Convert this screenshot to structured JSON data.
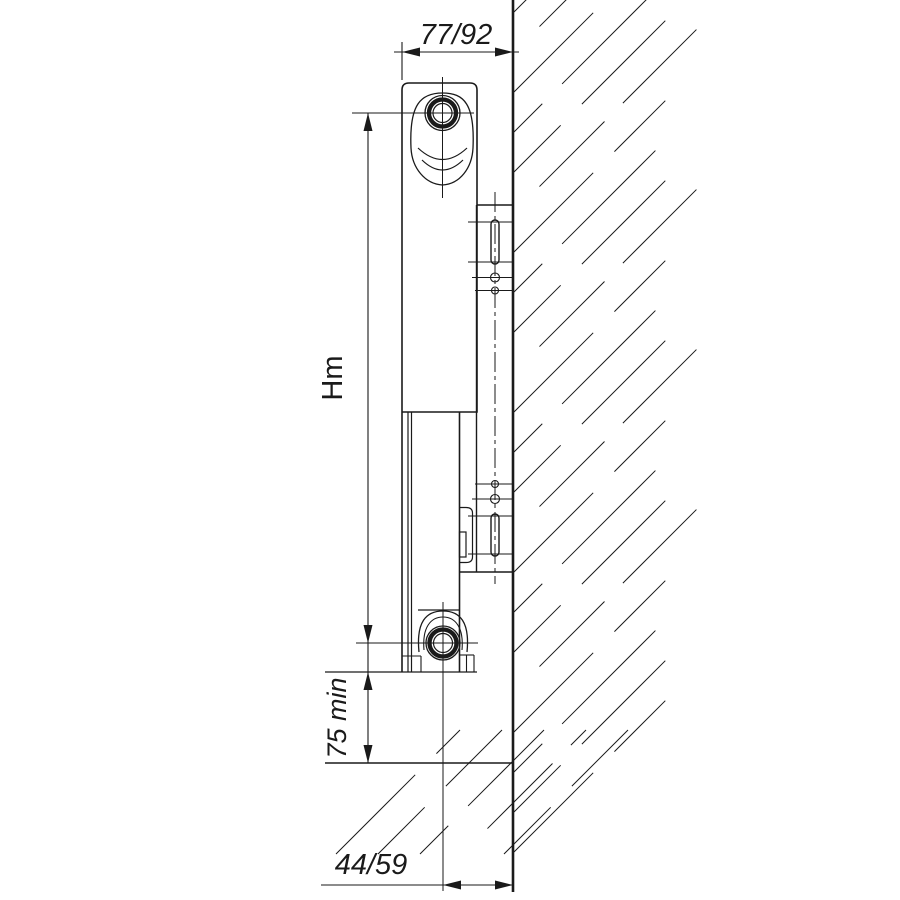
{
  "drawing": {
    "labels": {
      "top_width": "77/92",
      "mount_height": "Hm",
      "floor_clearance": "75 min",
      "wall_offset": "44/59"
    },
    "colors": {
      "line": "#1a1a1a",
      "background": "#ffffff"
    }
  }
}
